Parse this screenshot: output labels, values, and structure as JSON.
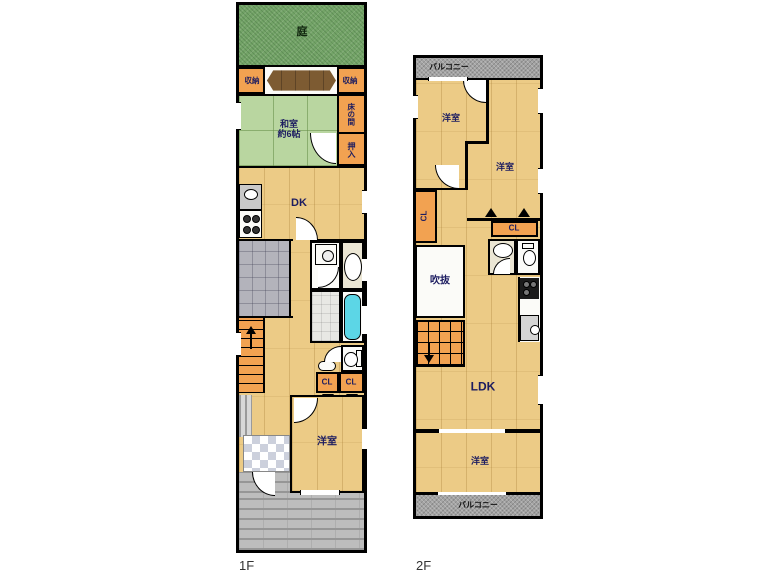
{
  "colors": {
    "wall": "#000000",
    "wood_floor": "#eccb86",
    "tatami_green": "#b9d6a0",
    "garden_green": "#74a468",
    "closet_orange": "#f2a251",
    "balcony_gray": "#a2a2a2",
    "driveway_gray": "#bdbdbd",
    "bathtub_cyan": "#5cd6e6",
    "deck_brown": "#7d5b32",
    "label_navy": "#1c1c60"
  },
  "floor1": {
    "name": "1F",
    "garden": "庭",
    "storage_left": "収納",
    "storage_right": "収納",
    "washitsu_line1": "和室",
    "washitsu_line2": "約6帖",
    "tokonoma": "床の間",
    "oshiire": "押入",
    "dk": "DK",
    "cl_left": "CL",
    "cl_right": "CL",
    "bedroom": "洋室"
  },
  "floor2": {
    "name": "2F",
    "balcony_top": "バルコニー",
    "bedroom_nw": "洋室",
    "bedroom_ne": "洋室",
    "cl_side": "CL",
    "cl_mid": "CL",
    "void": "吹抜",
    "ldk": "LDK",
    "bedroom_s": "洋室",
    "balcony_bottom": "バルコニー"
  }
}
